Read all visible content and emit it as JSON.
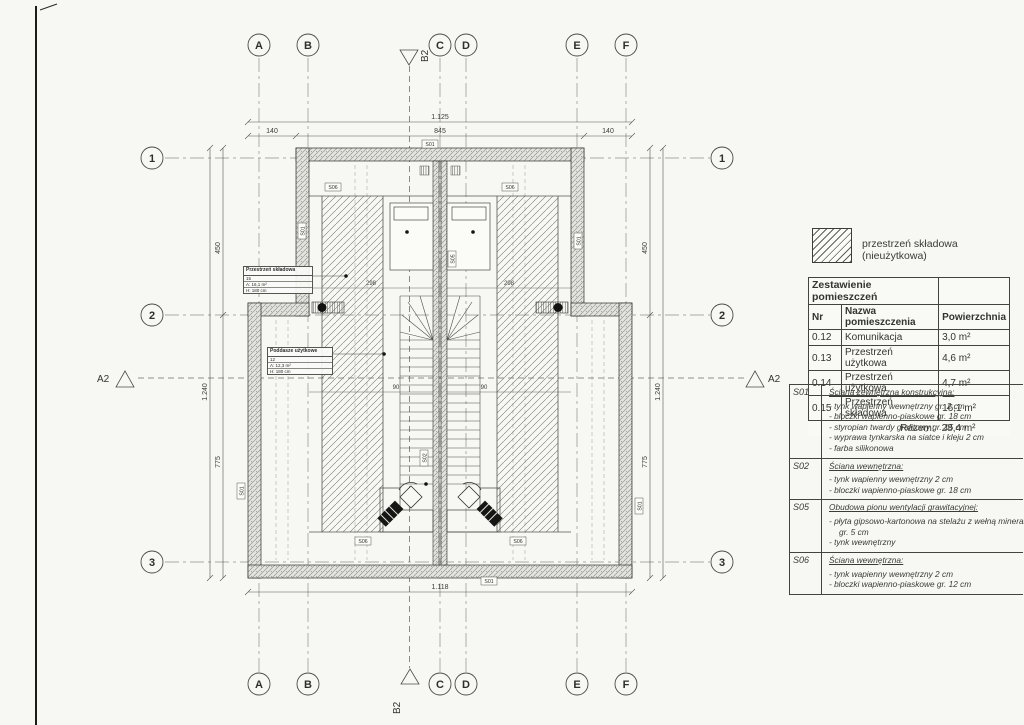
{
  "plan": {
    "grid_cols": [
      {
        "label": "A"
      },
      {
        "label": "B"
      },
      {
        "label": "C"
      },
      {
        "label": "D"
      },
      {
        "label": "E"
      },
      {
        "label": "F"
      }
    ],
    "grid_rows": [
      {
        "label": "1"
      },
      {
        "label": "2"
      },
      {
        "label": "3"
      }
    ],
    "section_markers": {
      "a2": "A2",
      "b2": "B2"
    },
    "dims": {
      "top_total": "1.125",
      "top_left": "140",
      "top_mid": "845",
      "top_right": "140",
      "bottom_total": "1.118",
      "side_upper": "450",
      "side_lower": "775",
      "side_total": "1.240",
      "inner_a": "298",
      "inner_b": "298",
      "inner_c": "90",
      "inner_d": "90"
    },
    "wall_tags": [
      {
        "t": "S01"
      },
      {
        "t": "S06"
      },
      {
        "t": "S06"
      },
      {
        "t": "S01"
      },
      {
        "t": "S01"
      },
      {
        "t": "S05"
      },
      {
        "t": "S02"
      },
      {
        "t": "S06"
      },
      {
        "t": "S06"
      },
      {
        "t": "S01"
      },
      {
        "t": "S01"
      },
      {
        "t": "S01"
      }
    ],
    "room_box_1": {
      "title": "Przestrzeń składowa",
      "r1": "15",
      "r2": "A: 16,1 m²",
      "r3": "H: 180 cm"
    },
    "room_box_2": {
      "title": "Poddasze użytkowe",
      "r1": "12",
      "r2": "A: 12,3 m²",
      "r3": "H: 180 cm"
    }
  },
  "legend": {
    "label": "przestrzeń składowa (nieużytkowa)"
  },
  "rooms_table": {
    "title": "Zestawienie pomieszczeń",
    "col_nr": "Nr",
    "col_name": "Nazwa pomieszczenia",
    "col_area": "Powierzchnia",
    "rows": [
      {
        "nr": "0.12",
        "name": "Komunikacja",
        "area": "3,0 m²"
      },
      {
        "nr": "0.13",
        "name": "Przestrzeń użytkowa",
        "area": "4,6 m²"
      },
      {
        "nr": "0.14",
        "name": "Przestrzeń użytkowa",
        "area": "4,7 m²"
      },
      {
        "nr": "0.15",
        "name": "Przestrzeń składowa",
        "area": "16,1 m²"
      }
    ],
    "total_label": "Razem:",
    "total_value": "28,4 m²"
  },
  "notes": [
    {
      "code": "S01",
      "title": "Ściana zewnętrzna konstrukcyjna:",
      "lines": [
        "- tynk wapienny wewnętrzny gr. 2 cm",
        "- bloczki wapienno-piaskowe gr. 18 cm",
        "- styropian twardy grafitowy gr. 15 cm",
        "- wyprawa tynkarska na siatce i kleju 2 cm",
        "- farba silikonowa"
      ]
    },
    {
      "code": "S02",
      "title": "Ściana wewnętrzna:",
      "lines": [
        "- tynk wapienny wewnętrzny 2 cm",
        "- bloczki wapienno-piaskowe gr. 18 cm"
      ]
    },
    {
      "code": "S05",
      "title": "Obudowa pionu wentylacji grawitacyjnej:",
      "lines": [
        "- płyta gipsowo-kartonowa na stelażu z wełną mineralną",
        "gr. 5 cm",
        "- tynk wewnętrzny"
      ]
    },
    {
      "code": "S06",
      "title": "Ściana wewnętrzna:",
      "lines": [
        "- tynk wapienny wewnętrzny 2 cm",
        "- bloczki wapienno-piaskowe gr. 12 cm"
      ]
    }
  ],
  "colors": {
    "paper": "#f7f7f4",
    "ink": "#3a3a3a",
    "wall_fill": "#e0e0dc",
    "hatch": "#6b6b66"
  }
}
